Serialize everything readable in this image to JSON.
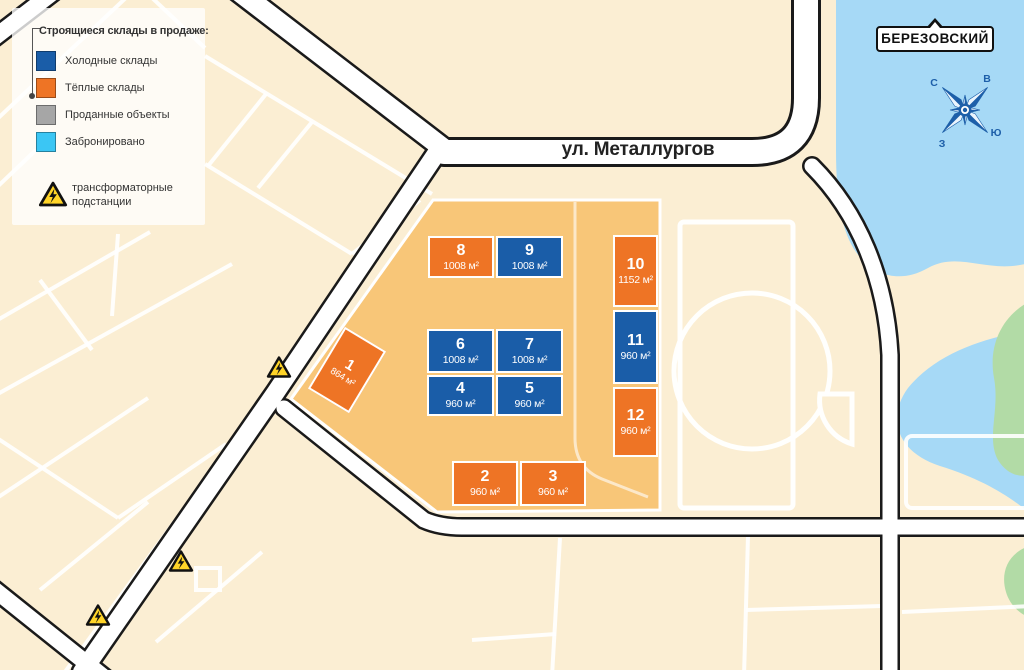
{
  "legend": {
    "title": "Строящиеся склады в продаже:",
    "items": [
      {
        "label": "Холодные склады",
        "type": "cold",
        "color": "#1A5DA8"
      },
      {
        "label": "Тёплые склады",
        "type": "warm",
        "color": "#EE7425"
      },
      {
        "label": "Проданные объекты",
        "type": "sold",
        "color": "#A6A6A6"
      },
      {
        "label": "Забронировано",
        "type": "reserved",
        "color": "#3BC6F4"
      }
    ],
    "transformer_label": "трансформаторные подстанции"
  },
  "map": {
    "street_label": "ул. Металлургов",
    "town_label": "БЕРЕЗОВСКИЙ",
    "compass": {
      "north": "С",
      "east": "В",
      "south": "Ю",
      "west": "З"
    }
  },
  "warehouses": [
    {
      "id": "1",
      "area": "864 м²",
      "type": "warm"
    },
    {
      "id": "2",
      "area": "960 м²",
      "type": "warm"
    },
    {
      "id": "3",
      "area": "960 м²",
      "type": "warm"
    },
    {
      "id": "4",
      "area": "960 м²",
      "type": "cold"
    },
    {
      "id": "5",
      "area": "960 м²",
      "type": "cold"
    },
    {
      "id": "6",
      "area": "1008 м²",
      "type": "cold"
    },
    {
      "id": "7",
      "area": "1008 м²",
      "type": "cold"
    },
    {
      "id": "8",
      "area": "1008 м²",
      "type": "warm"
    },
    {
      "id": "9",
      "area": "1008 м²",
      "type": "cold"
    },
    {
      "id": "10",
      "area": "1152 м²",
      "type": "warm"
    },
    {
      "id": "11",
      "area": "960 м²",
      "type": "cold"
    },
    {
      "id": "12",
      "area": "960 м²",
      "type": "warm"
    }
  ],
  "colors": {
    "cold_warehouse": "#1A5DA8",
    "warm_warehouse": "#EE7425",
    "sold_object": "#A6A6A6",
    "reserved": "#3BC6F4",
    "site_fill": "#F8C678",
    "map_background": "#FBEED3",
    "lake": "#A6D9F6",
    "greenery": "#B2DBA6",
    "road_fill": "#FFFFFF",
    "road_casing": "#1A1A1A",
    "transformer_yellow": "#FFD428"
  }
}
